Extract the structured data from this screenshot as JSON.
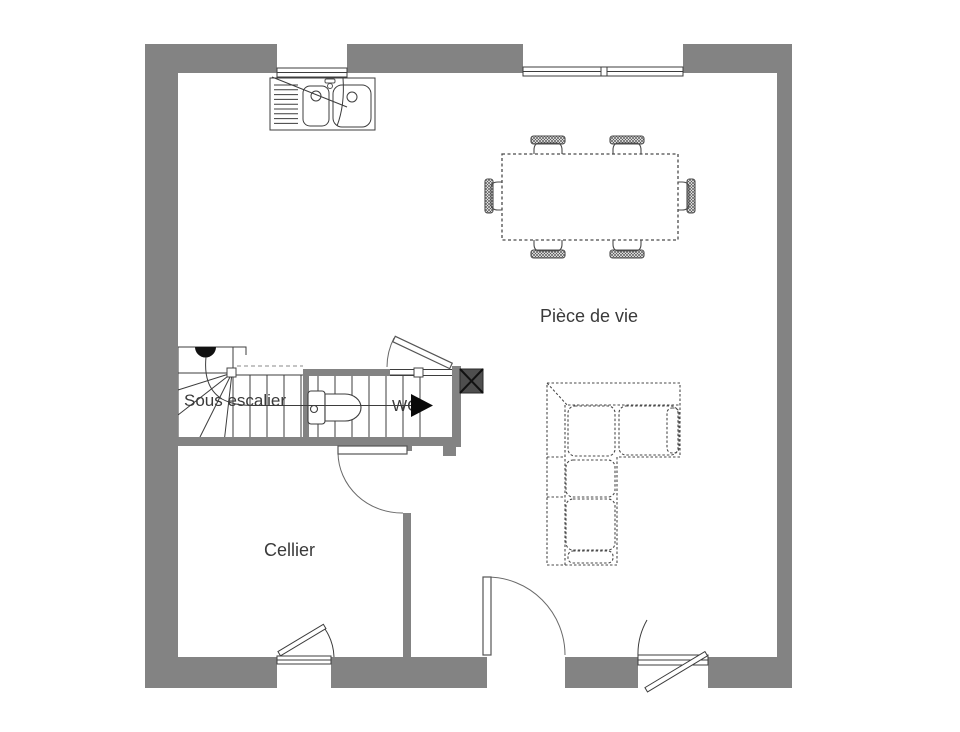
{
  "plan": {
    "type": "floor-plan-ground-floor",
    "labels": {
      "living_room": "Pièce de vie",
      "cellar": "Cellier",
      "under_stairs": "Sous escalier",
      "wc": "WC"
    },
    "colors": {
      "wall": "#838383",
      "duct": "#4e4e4e",
      "line": "#3d3d3d",
      "text": "#3a3a3a",
      "background": "#ffffff"
    },
    "symbols": [
      "kitchen-double-sink",
      "dining-table-6-chairs",
      "corner-sofa",
      "winder-staircase",
      "toilet",
      "entrance-door",
      "interior-doors",
      "casement-windows",
      "duct-x-marker"
    ]
  }
}
